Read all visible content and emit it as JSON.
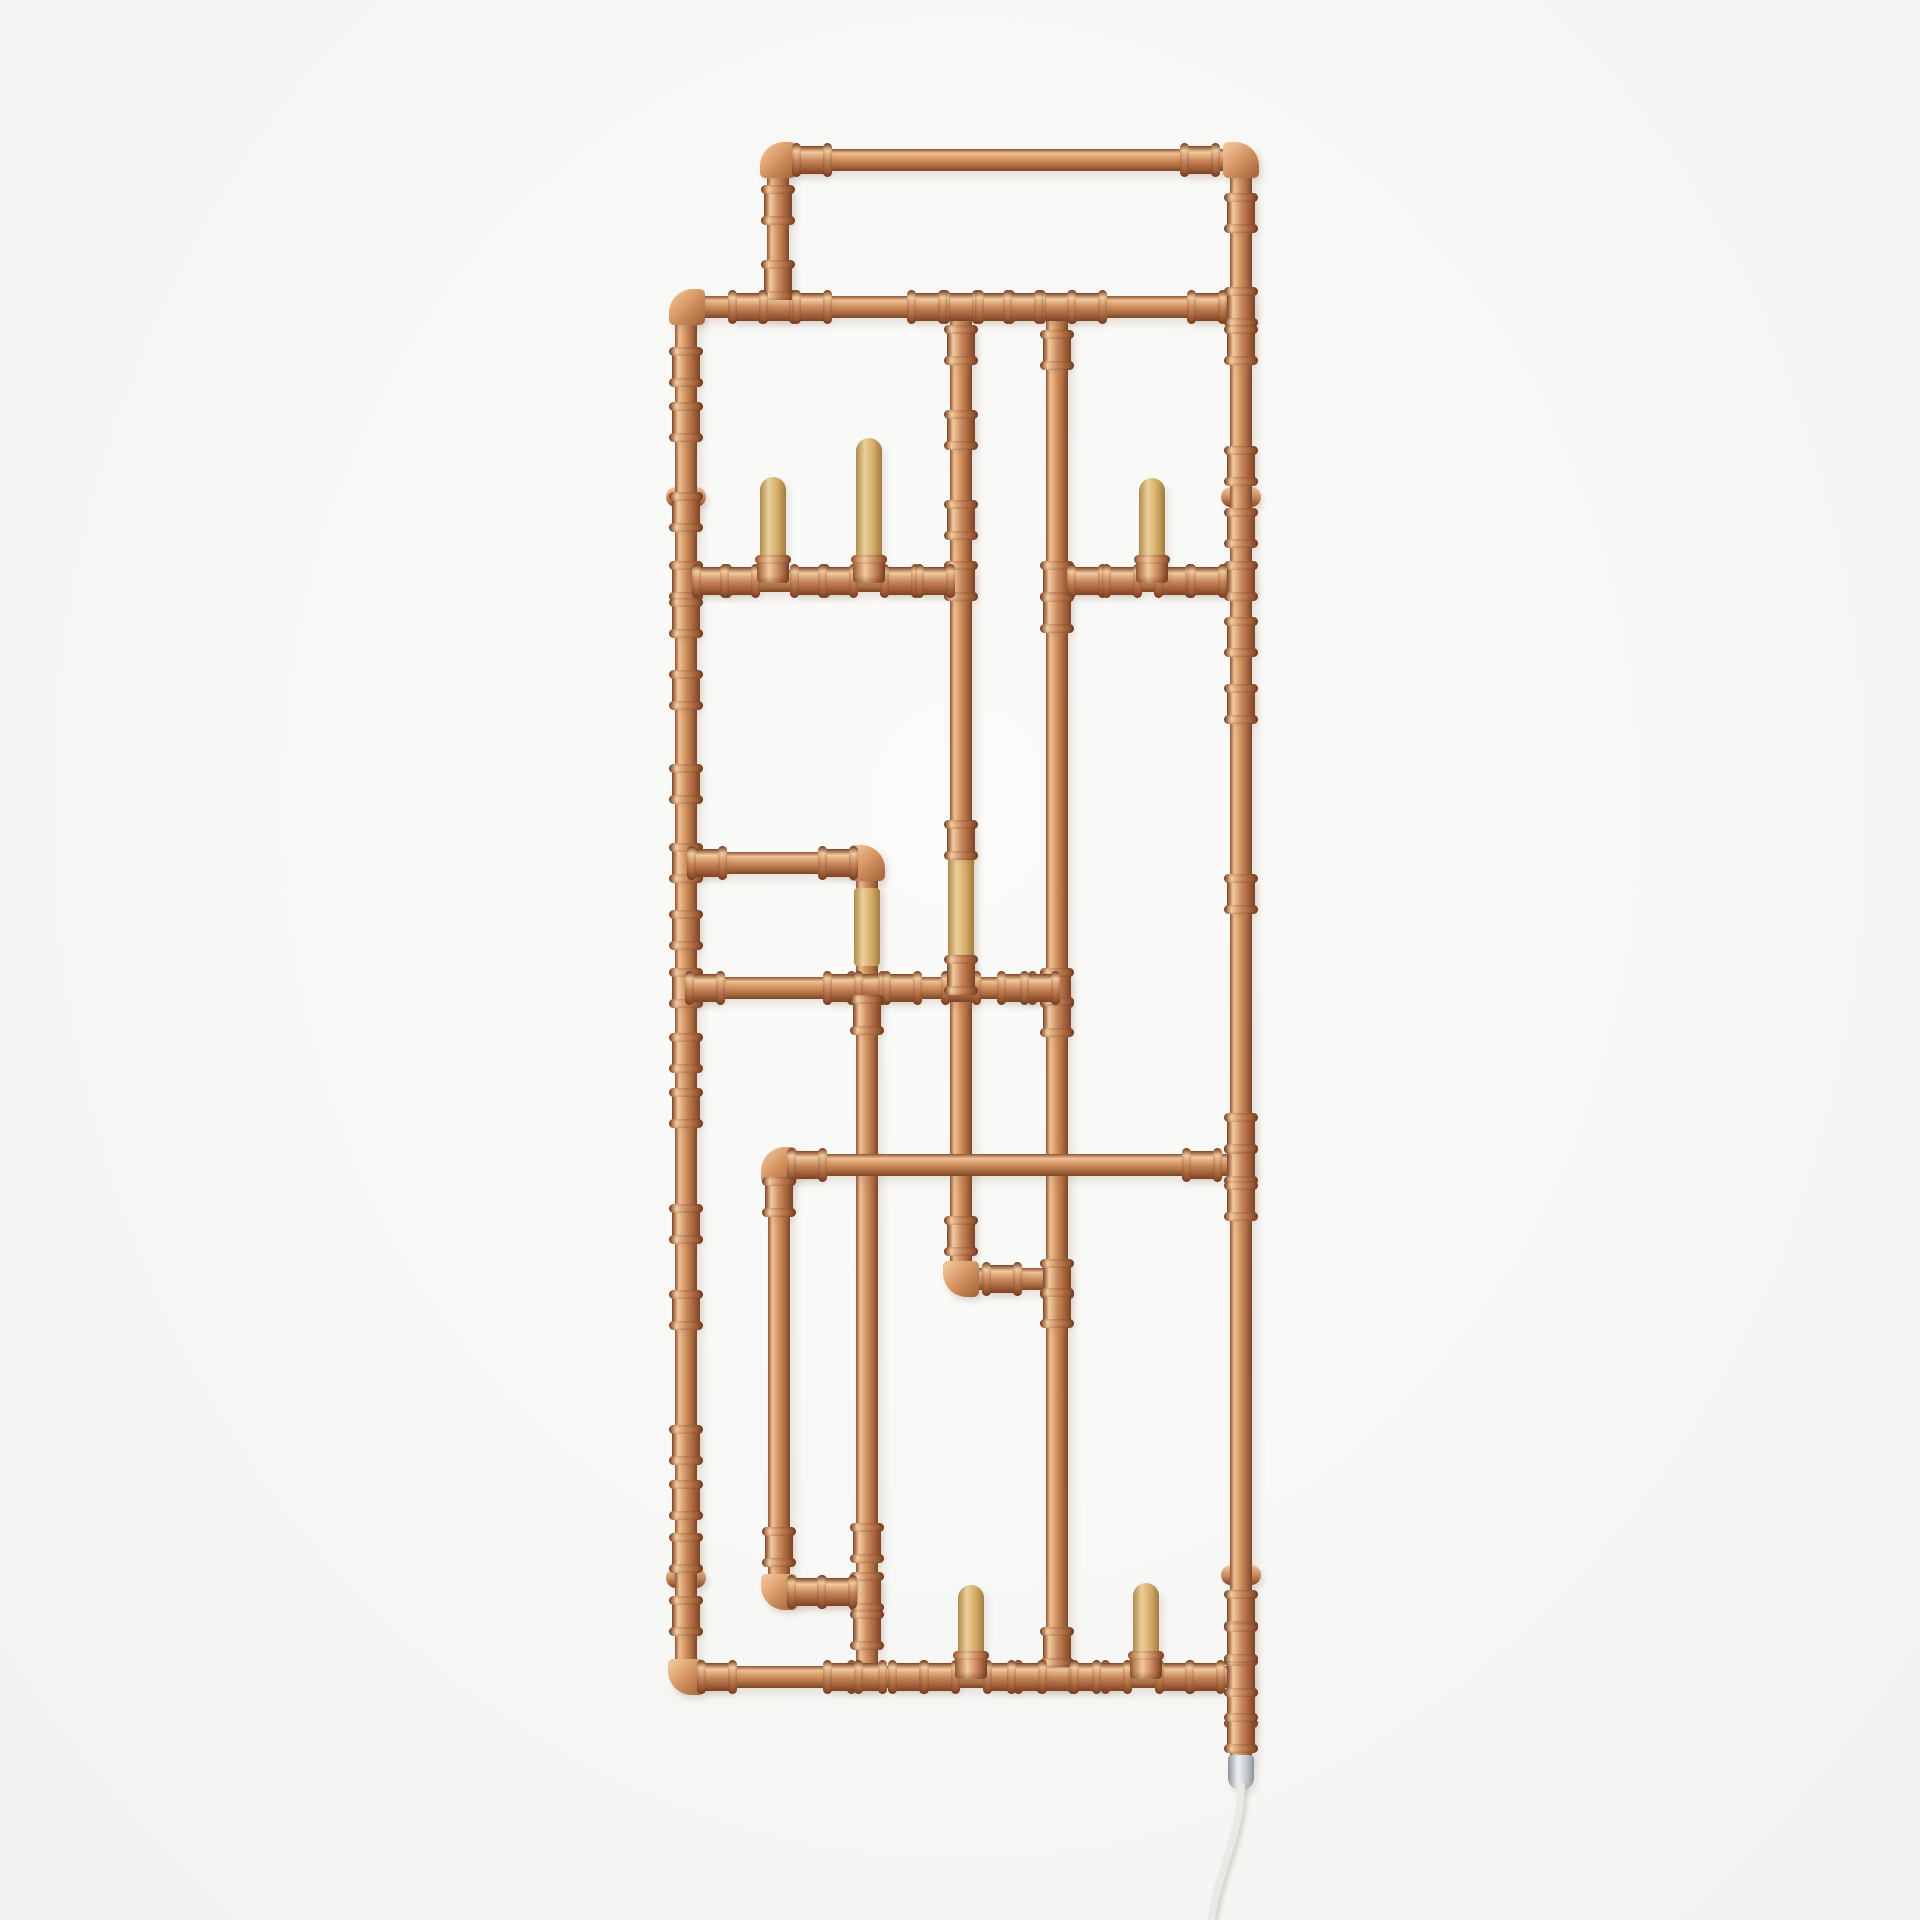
{
  "meta": {
    "description": "Product photo: wall-mounted industrial copper pipe coat rack / electric towel radiator with wooden pegs, press fittings, wall brackets, chrome heating element and white power cable on a white studio background",
    "canvas": {
      "width": 1920,
      "height": 1920
    }
  },
  "palette": {
    "bg": "#f6f6f4",
    "copper_edge": "#8f5434",
    "copper_hi": "#efc094",
    "copper_mid": "#d2925f",
    "copper_lo": "#a96a40",
    "copper_edge2": "#7a4527",
    "fit_edge": "#7e4326",
    "fit_hi": "#f3cb9e",
    "fit_mid": "#c9885c",
    "fit_lo": "#a05f38",
    "wood_lo": "#b08a4a",
    "wood_hi": "#ecd09b",
    "wood_mid": "#d4ab66",
    "wood_lo2": "#9e7c40",
    "chrome_hi": "#eef1f2",
    "chrome_mid": "#c4cacd",
    "chrome_dark": "#8d9498",
    "cable": "#e9e9e7",
    "shadow": "rgba(150,110,85,0.16)"
  },
  "scene": {
    "pipe_width": 22,
    "verticals": [
      {
        "id": "header-left",
        "x": 778,
        "y1": 160,
        "y2": 307
      },
      {
        "id": "right-rail",
        "x": 1241,
        "y1": 160,
        "y2": 1755
      },
      {
        "id": "left-rail",
        "x": 686,
        "y1": 307,
        "y2": 1677
      },
      {
        "id": "mid-drop",
        "x": 961,
        "y1": 307,
        "y2": 1279
      },
      {
        "id": "inner-right-drop",
        "x": 1057,
        "y1": 307,
        "y2": 1677
      },
      {
        "id": "loop-drop",
        "x": 867,
        "y1": 863,
        "y2": 1677
      },
      {
        "id": "lower-left-drop",
        "x": 779,
        "y1": 1165,
        "y2": 1592
      }
    ],
    "horizontals": [
      {
        "id": "top-bar",
        "y": 160,
        "x1": 778,
        "x2": 1241
      },
      {
        "id": "upper-bar",
        "y": 307,
        "x1": 687,
        "x2": 1241
      },
      {
        "id": "left-peg-bar",
        "y": 581,
        "x1": 686,
        "x2": 961
      },
      {
        "id": "right-peg-bar",
        "y": 581,
        "x1": 1057,
        "x2": 1241
      },
      {
        "id": "loop-top-bar",
        "y": 863,
        "x1": 686,
        "x2": 867
      },
      {
        "id": "mid-bar",
        "y": 988,
        "x1": 686,
        "x2": 1057
      },
      {
        "id": "lower-bar",
        "y": 1165,
        "x1": 779,
        "x2": 1241
      },
      {
        "id": "jog-bar",
        "y": 1279,
        "x1": 961,
        "x2": 1057
      },
      {
        "id": "bottom-jog-bar",
        "y": 1592,
        "x1": 779,
        "x2": 867
      },
      {
        "id": "bottom-bar",
        "y": 1677,
        "x1": 686,
        "x2": 1241
      }
    ],
    "elbows": [
      {
        "x": 778,
        "y": 160,
        "corner": "tl"
      },
      {
        "x": 1241,
        "y": 160,
        "corner": "tr"
      },
      {
        "x": 687,
        "y": 307,
        "corner": "tl"
      },
      {
        "x": 867,
        "y": 863,
        "corner": "tr"
      },
      {
        "x": 779,
        "y": 1165,
        "corner": "tl"
      },
      {
        "x": 961,
        "y": 1279,
        "corner": "bl"
      },
      {
        "x": 779,
        "y": 1592,
        "corner": "bl"
      },
      {
        "x": 686,
        "y": 1677,
        "corner": "bl"
      }
    ],
    "tees": [
      {
        "x": 778,
        "y": 307,
        "dir": "h"
      },
      {
        "x": 961,
        "y": 307,
        "dir": "h"
      },
      {
        "x": 1057,
        "y": 307,
        "dir": "h"
      },
      {
        "x": 1241,
        "y": 307,
        "dir": "v"
      },
      {
        "x": 686,
        "y": 581,
        "dir": "v"
      },
      {
        "x": 961,
        "y": 581,
        "dir": "v"
      },
      {
        "x": 1057,
        "y": 581,
        "dir": "v"
      },
      {
        "x": 1241,
        "y": 581,
        "dir": "v"
      },
      {
        "x": 686,
        "y": 863,
        "dir": "v"
      },
      {
        "x": 686,
        "y": 988,
        "dir": "v"
      },
      {
        "x": 867,
        "y": 988,
        "dir": "h"
      },
      {
        "x": 961,
        "y": 988,
        "dir": "h"
      },
      {
        "x": 1057,
        "y": 988,
        "dir": "v"
      },
      {
        "x": 1241,
        "y": 1165,
        "dir": "v"
      },
      {
        "x": 1057,
        "y": 1279,
        "dir": "v"
      },
      {
        "x": 867,
        "y": 1592,
        "dir": "v"
      },
      {
        "x": 867,
        "y": 1677,
        "dir": "h"
      },
      {
        "x": 1057,
        "y": 1677,
        "dir": "h"
      },
      {
        "x": 1241,
        "y": 1677,
        "dir": "v"
      }
    ],
    "couplings": [
      {
        "x": 812,
        "y": 160,
        "dir": "h"
      },
      {
        "x": 1200,
        "y": 160,
        "dir": "h"
      },
      {
        "x": 778,
        "y": 205,
        "dir": "v"
      },
      {
        "x": 778,
        "y": 280,
        "dir": "v"
      },
      {
        "x": 748,
        "y": 307,
        "dir": "h"
      },
      {
        "x": 812,
        "y": 307,
        "dir": "h"
      },
      {
        "x": 927,
        "y": 307,
        "dir": "h"
      },
      {
        "x": 995,
        "y": 307,
        "dir": "h"
      },
      {
        "x": 1023,
        "y": 307,
        "dir": "h"
      },
      {
        "x": 1087,
        "y": 307,
        "dir": "h"
      },
      {
        "x": 1207,
        "y": 307,
        "dir": "h"
      },
      {
        "x": 1241,
        "y": 213,
        "dir": "v"
      },
      {
        "x": 1241,
        "y": 345,
        "dir": "v"
      },
      {
        "x": 1241,
        "y": 466,
        "dir": "v"
      },
      {
        "x": 1241,
        "y": 528,
        "dir": "v"
      },
      {
        "x": 1241,
        "y": 637,
        "dir": "v"
      },
      {
        "x": 1241,
        "y": 704,
        "dir": "v"
      },
      {
        "x": 1241,
        "y": 894,
        "dir": "v"
      },
      {
        "x": 1241,
        "y": 1133,
        "dir": "v"
      },
      {
        "x": 1241,
        "y": 1201,
        "dir": "v"
      },
      {
        "x": 1241,
        "y": 1610,
        "dir": "v"
      },
      {
        "x": 1241,
        "y": 1643,
        "dir": "v"
      },
      {
        "x": 1241,
        "y": 1708,
        "dir": "v"
      },
      {
        "x": 1241,
        "y": 1733,
        "dir": "v"
      },
      {
        "x": 686,
        "y": 367,
        "dir": "v"
      },
      {
        "x": 686,
        "y": 422,
        "dir": "v"
      },
      {
        "x": 686,
        "y": 512,
        "dir": "v"
      },
      {
        "x": 686,
        "y": 618,
        "dir": "v"
      },
      {
        "x": 686,
        "y": 690,
        "dir": "v"
      },
      {
        "x": 686,
        "y": 784,
        "dir": "v"
      },
      {
        "x": 686,
        "y": 930,
        "dir": "v"
      },
      {
        "x": 686,
        "y": 1053,
        "dir": "v"
      },
      {
        "x": 686,
        "y": 1108,
        "dir": "v"
      },
      {
        "x": 686,
        "y": 1224,
        "dir": "v"
      },
      {
        "x": 686,
        "y": 1310,
        "dir": "v"
      },
      {
        "x": 686,
        "y": 1445,
        "dir": "v"
      },
      {
        "x": 686,
        "y": 1500,
        "dir": "v"
      },
      {
        "x": 686,
        "y": 1553,
        "dir": "v"
      },
      {
        "x": 686,
        "y": 1616,
        "dir": "v"
      },
      {
        "x": 712,
        "y": 581,
        "dir": "h"
      },
      {
        "x": 740,
        "y": 581,
        "dir": "h"
      },
      {
        "x": 810,
        "y": 581,
        "dir": "h"
      },
      {
        "x": 838,
        "y": 581,
        "dir": "h"
      },
      {
        "x": 900,
        "y": 581,
        "dir": "h"
      },
      {
        "x": 935,
        "y": 581,
        "dir": "h"
      },
      {
        "x": 1087,
        "y": 581,
        "dir": "h"
      },
      {
        "x": 1122,
        "y": 581,
        "dir": "h"
      },
      {
        "x": 1174,
        "y": 581,
        "dir": "h"
      },
      {
        "x": 1207,
        "y": 581,
        "dir": "h"
      },
      {
        "x": 961,
        "y": 345,
        "dir": "v"
      },
      {
        "x": 961,
        "y": 430,
        "dir": "v"
      },
      {
        "x": 961,
        "y": 520,
        "dir": "v"
      },
      {
        "x": 961,
        "y": 840,
        "dir": "v"
      },
      {
        "x": 961,
        "y": 975,
        "dir": "v"
      },
      {
        "x": 961,
        "y": 1236,
        "dir": "v"
      },
      {
        "x": 1057,
        "y": 350,
        "dir": "v"
      },
      {
        "x": 1057,
        "y": 613,
        "dir": "v"
      },
      {
        "x": 1057,
        "y": 1017,
        "dir": "v"
      },
      {
        "x": 1057,
        "y": 1308,
        "dir": "v"
      },
      {
        "x": 1057,
        "y": 1647,
        "dir": "v"
      },
      {
        "x": 707,
        "y": 863,
        "dir": "h"
      },
      {
        "x": 838,
        "y": 863,
        "dir": "h"
      },
      {
        "x": 705,
        "y": 988,
        "dir": "h"
      },
      {
        "x": 843,
        "y": 988,
        "dir": "h"
      },
      {
        "x": 902,
        "y": 988,
        "dir": "h"
      },
      {
        "x": 1017,
        "y": 988,
        "dir": "h"
      },
      {
        "x": 1040,
        "y": 988,
        "dir": "h"
      },
      {
        "x": 807,
        "y": 1165,
        "dir": "h"
      },
      {
        "x": 1202,
        "y": 1165,
        "dir": "h"
      },
      {
        "x": 1002,
        "y": 1279,
        "dir": "h"
      },
      {
        "x": 867,
        "y": 1015,
        "dir": "v"
      },
      {
        "x": 867,
        "y": 1543,
        "dir": "v"
      },
      {
        "x": 867,
        "y": 1630,
        "dir": "v"
      },
      {
        "x": 779,
        "y": 1197,
        "dir": "v"
      },
      {
        "x": 779,
        "y": 1547,
        "dir": "v"
      },
      {
        "x": 807,
        "y": 1592,
        "dir": "h"
      },
      {
        "x": 837,
        "y": 1592,
        "dir": "h"
      },
      {
        "x": 717,
        "y": 1677,
        "dir": "h"
      },
      {
        "x": 843,
        "y": 1677,
        "dir": "h"
      },
      {
        "x": 908,
        "y": 1677,
        "dir": "h"
      },
      {
        "x": 940,
        "y": 1677,
        "dir": "h"
      },
      {
        "x": 1003,
        "y": 1677,
        "dir": "h"
      },
      {
        "x": 1027,
        "y": 1677,
        "dir": "h"
      },
      {
        "x": 1090,
        "y": 1677,
        "dir": "h"
      },
      {
        "x": 1112,
        "y": 1677,
        "dir": "h"
      },
      {
        "x": 1175,
        "y": 1677,
        "dir": "h"
      },
      {
        "x": 1205,
        "y": 1677,
        "dir": "h"
      }
    ],
    "pegs": [
      {
        "x": 773,
        "top": 477,
        "bottom": 572,
        "bar_y": 581
      },
      {
        "x": 869,
        "top": 438,
        "bottom": 572,
        "bar_y": 581
      },
      {
        "x": 1152,
        "top": 478,
        "bottom": 572,
        "bar_y": 581
      },
      {
        "x": 971,
        "top": 1585,
        "bottom": 1668,
        "bar_y": 1677
      },
      {
        "x": 1146,
        "top": 1583,
        "bottom": 1668,
        "bar_y": 1677
      }
    ],
    "sleeves": [
      {
        "x": 867,
        "top": 888,
        "bottom": 966
      },
      {
        "x": 961,
        "top": 847,
        "bottom": 973
      }
    ],
    "brackets": [
      {
        "x": 686,
        "y": 497
      },
      {
        "x": 1241,
        "y": 497
      },
      {
        "x": 686,
        "y": 1578
      },
      {
        "x": 1241,
        "y": 1575
      }
    ],
    "heater_cap": {
      "x": 1241,
      "top": 1755,
      "bottom": 1790
    },
    "cable": {
      "left": 1140,
      "top": 1782,
      "width": 170,
      "height": 138,
      "d": "M101,4 C101,52 78,88 71,138"
    }
  }
}
